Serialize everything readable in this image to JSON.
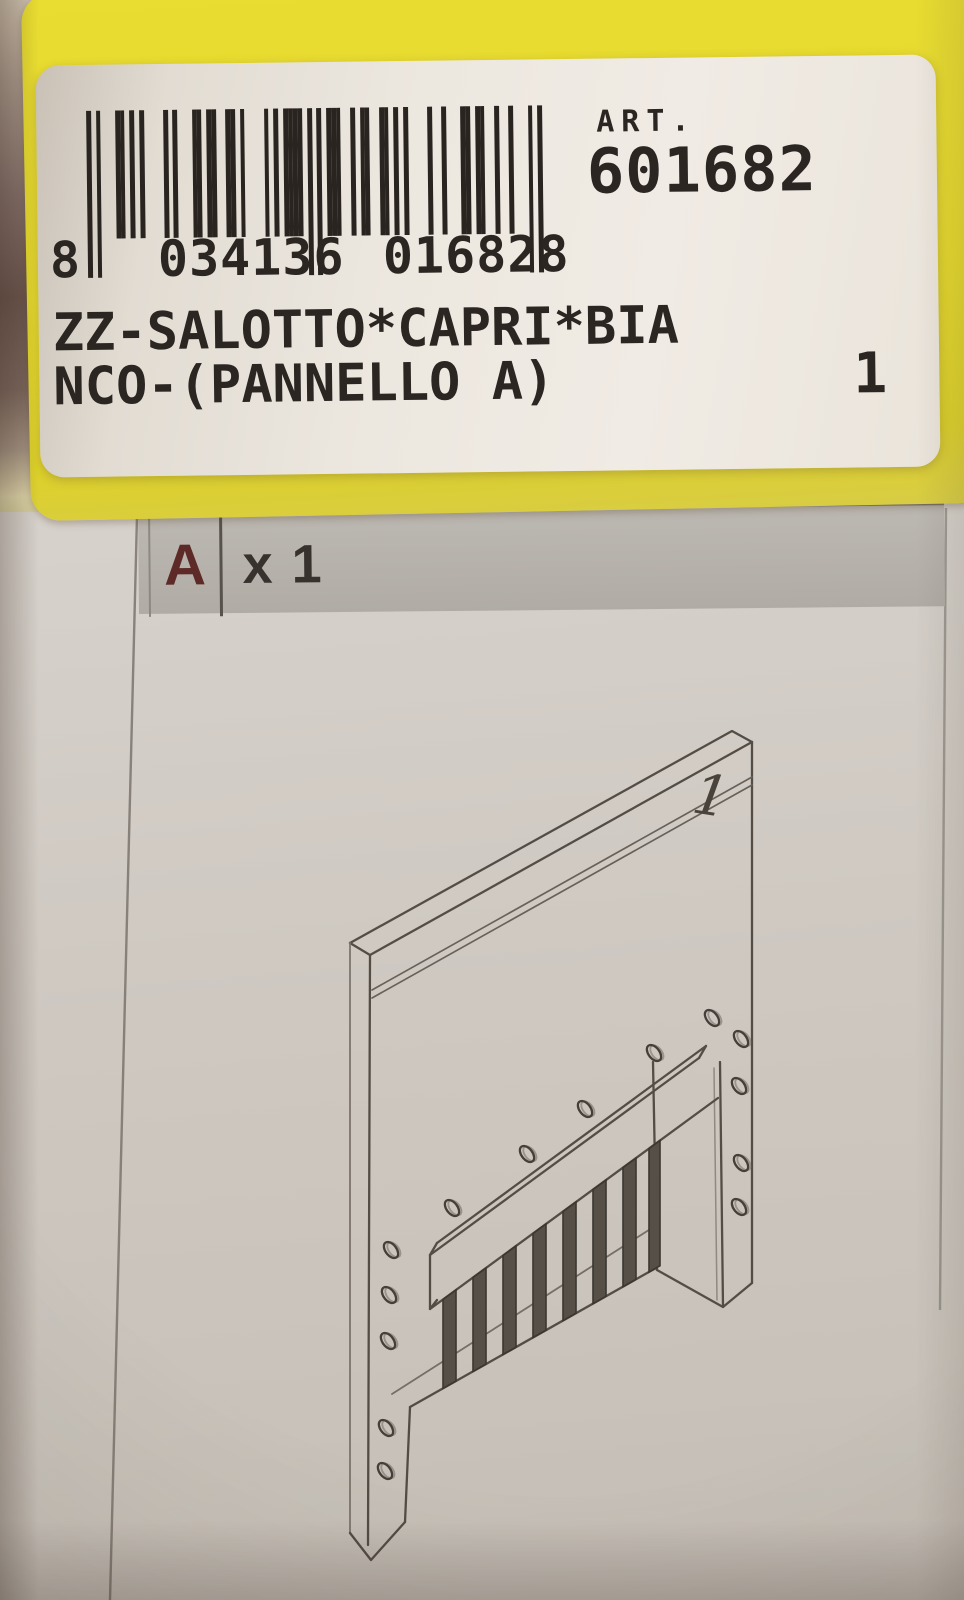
{
  "label": {
    "barcode": {
      "first_digit": "8",
      "left_group": "034136",
      "right_group": "016828",
      "full_number": "8 034136 016828",
      "pattern": "10100011010100001010001101100110100001010111101010111001011001101010000100100011011001001000101"
    },
    "art_caption": "ART.",
    "art_number": "601682",
    "product_line1": "ZZ-SALOTTO*CAPRI*BIA",
    "product_line2": "NCO-(PANNELLO A)",
    "quantity": "1"
  },
  "sheet": {
    "part_letter": "A",
    "part_count": "x 1",
    "diagram_marker": "1"
  },
  "colors": {
    "sticker_yellow": "#e4d82d",
    "label_white": "#ece7df",
    "paper_gray": "#cfc9c2",
    "header_bar_gray": "#b6b2ab",
    "part_letter_red": "#5d2a27",
    "ink_black": "#29241f",
    "diagram_line": "#4a433c"
  }
}
